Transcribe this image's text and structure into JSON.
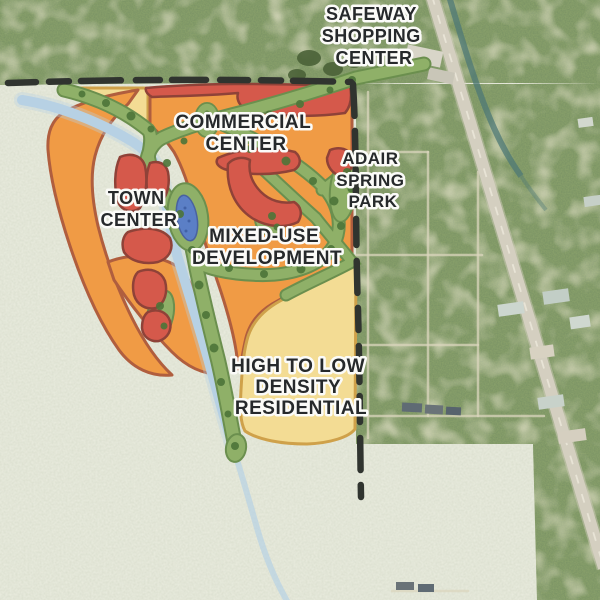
{
  "map": {
    "labels": {
      "safeway_shopping_center": {
        "lines": [
          "SAFEWAY",
          "SHOPPING",
          "CENTER"
        ]
      },
      "commercial_center": {
        "lines": [
          "COMMERCIAL",
          "CENTER"
        ]
      },
      "adair_spring_park": {
        "lines": [
          "ADAIR",
          "SPRING",
          "PARK"
        ]
      },
      "town_center": {
        "lines": [
          "TOWN",
          "CENTER"
        ]
      },
      "mixed_use_development": {
        "lines": [
          "MIXED-USE",
          "DEVELOPMENT"
        ]
      },
      "high_to_low_density_residential": {
        "lines": [
          "HIGH TO LOW",
          "DENSITY",
          "RESIDENTIAL"
        ]
      }
    },
    "palette": {
      "orange_zone": "#f09b45",
      "orange_edge": "#b05e3e",
      "red_zone": "#d5594b",
      "red_edge": "#8f4238",
      "yellow_zone": "#f3dc94",
      "yellow_edge": "#cfa14a",
      "green_road": "#8fb068",
      "green_road_edge": "#6b8f4e",
      "tree_green": "#4d7539",
      "stream_blue": "#b7d1e4",
      "pond_blue": "#5b7fc6",
      "boundary_dash": "#30342f",
      "label_ink": "#26292b",
      "label_halo": "#fbfbf8",
      "forest_green": "#8ba26b",
      "undeveloped_pale": "#eaecdf",
      "highway_gray": "#d4cfc0"
    }
  }
}
